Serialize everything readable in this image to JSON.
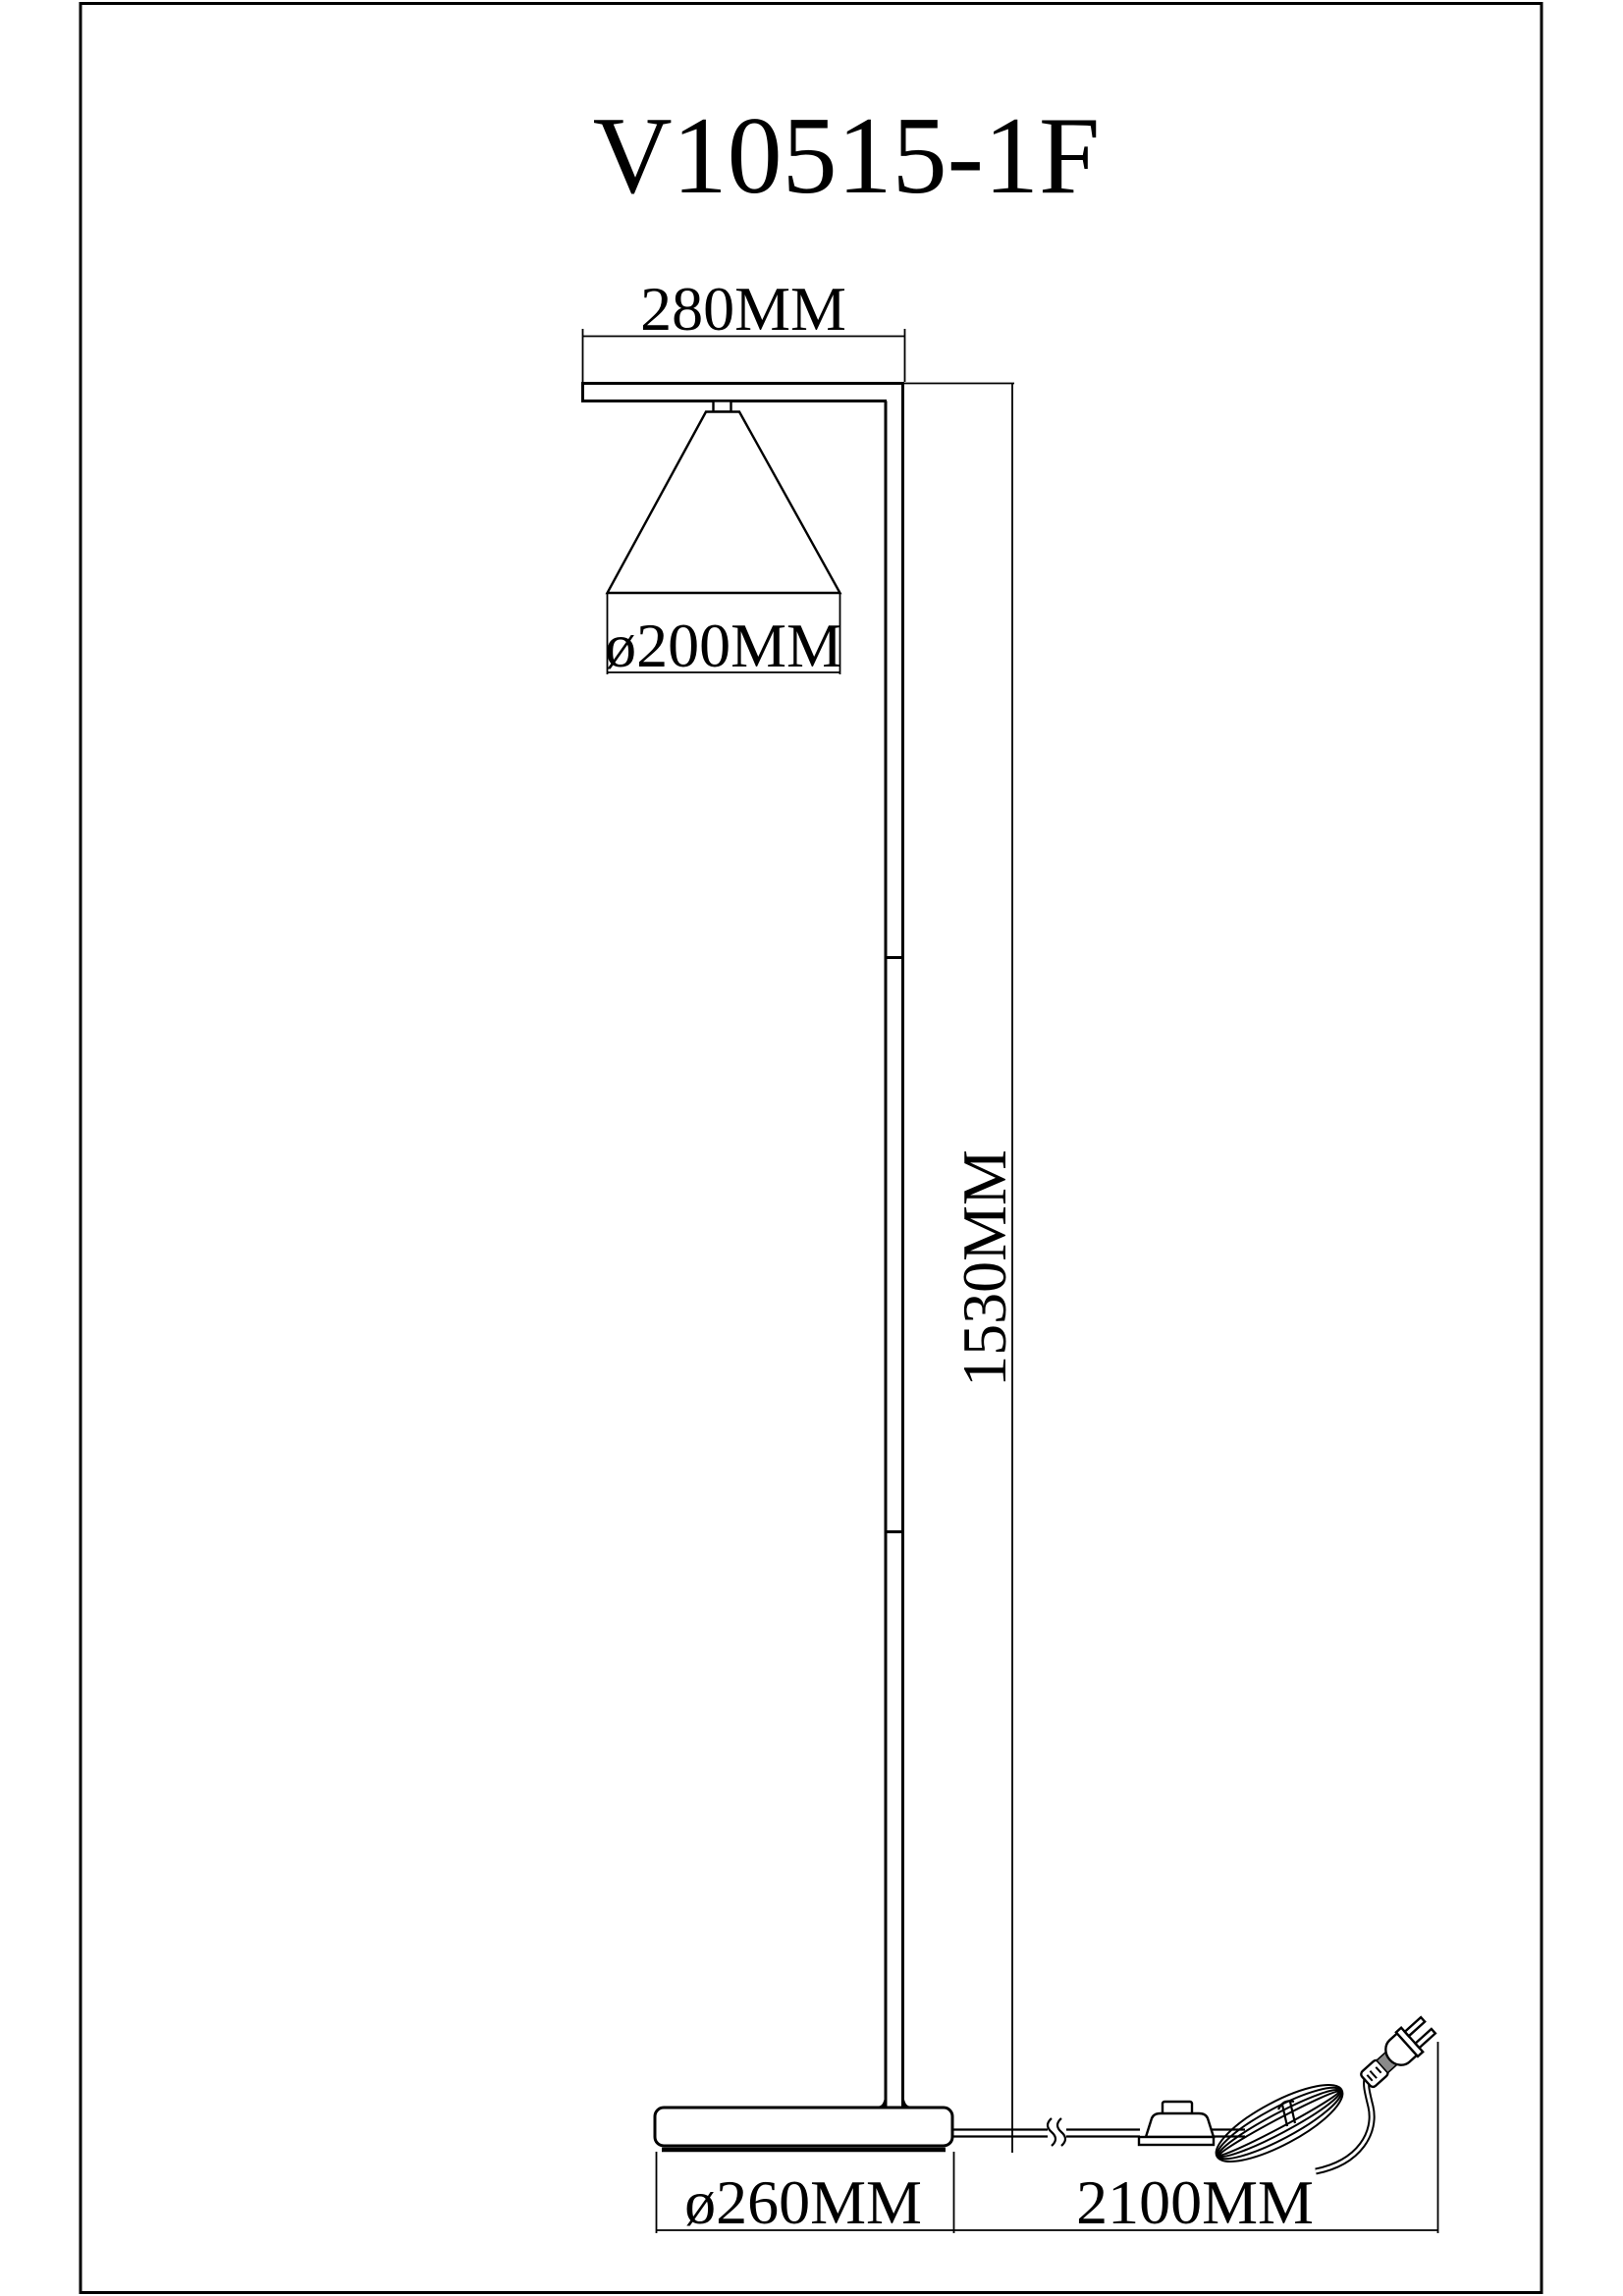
{
  "drawing": {
    "title": "V10515-1F",
    "dimensions": {
      "arm_width": "280MM",
      "shade_diameter": "ø200MM",
      "pole_height": "1530MM",
      "base_diameter": "ø260MM",
      "cord_length": "2100MM"
    },
    "colors": {
      "ink": "#000000",
      "paper": "#ffffff",
      "plug_grip_fill": "#8a8a8a"
    }
  }
}
